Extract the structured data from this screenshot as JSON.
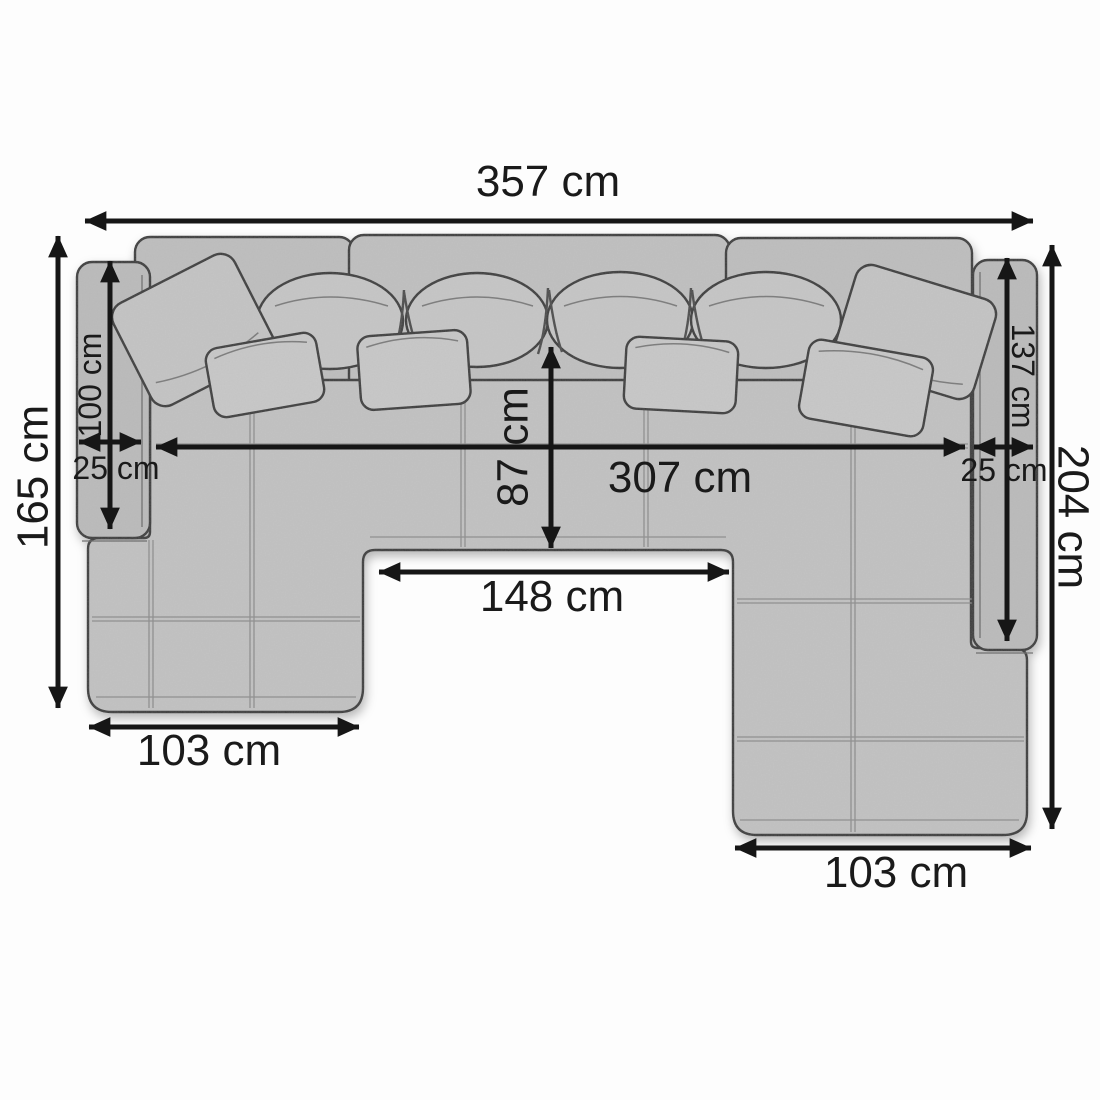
{
  "diagram": {
    "type": "sofa-top-view-dimension-diagram",
    "unit": "cm",
    "labels": {
      "total_width": "357 cm",
      "left_depth": "165 cm",
      "left_backrest": "100 cm",
      "left_armrest_width": "25 cm",
      "seat_depth": "87 cm",
      "inner_width": "307 cm",
      "right_armrest_width": "25 cm",
      "right_backrest": "137 cm",
      "right_depth": "204 cm",
      "center_seat_width": "148 cm",
      "left_chaise_width": "103 cm",
      "right_chaise_width": "103 cm"
    },
    "colors": {
      "background": "#fdfdfd",
      "fabric": "#c2c2c2",
      "fabric_dark": "#bcbcbc",
      "fabric_light": "#c8c8c8",
      "outline": "#383838",
      "seam": "#8f8f8f",
      "dimension": "#161616",
      "label_text": "#1a1a1a"
    }
  }
}
